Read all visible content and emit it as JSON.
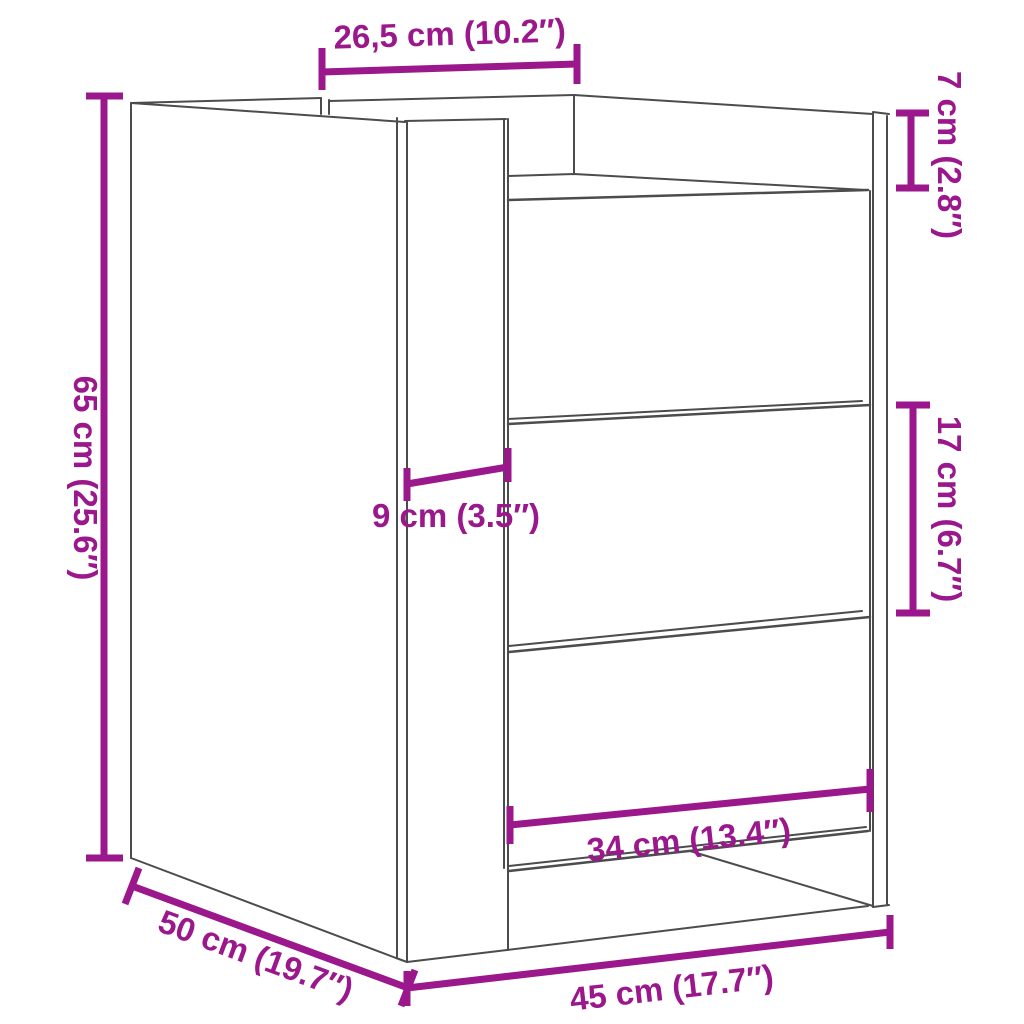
{
  "diagram": {
    "type": "furniture-dimension-drawing",
    "subject": "bedside cabinet with three drawers",
    "style": "black outline wireframe with magenta dimension lines on white background"
  },
  "dims": {
    "top_depth": {
      "label": "26,5 cm (10.2″)"
    },
    "top_clearance": {
      "label": "7 cm (2.8″)"
    },
    "height": {
      "label": "65 cm (25.6″)"
    },
    "front_offset": {
      "label": "9 cm (3.5″)"
    },
    "drawer_front_height": {
      "label": "17 cm (6.7″)"
    },
    "drawer_front_width": {
      "label": "34 cm (13.4″)"
    },
    "depth": {
      "label": "50 cm (19.7″)"
    },
    "width": {
      "label": "45 cm (17.7″)"
    }
  },
  "colors": {
    "dimension": "#9B178C",
    "outline": "#4C4C4E",
    "background": "#FFFFFF"
  }
}
